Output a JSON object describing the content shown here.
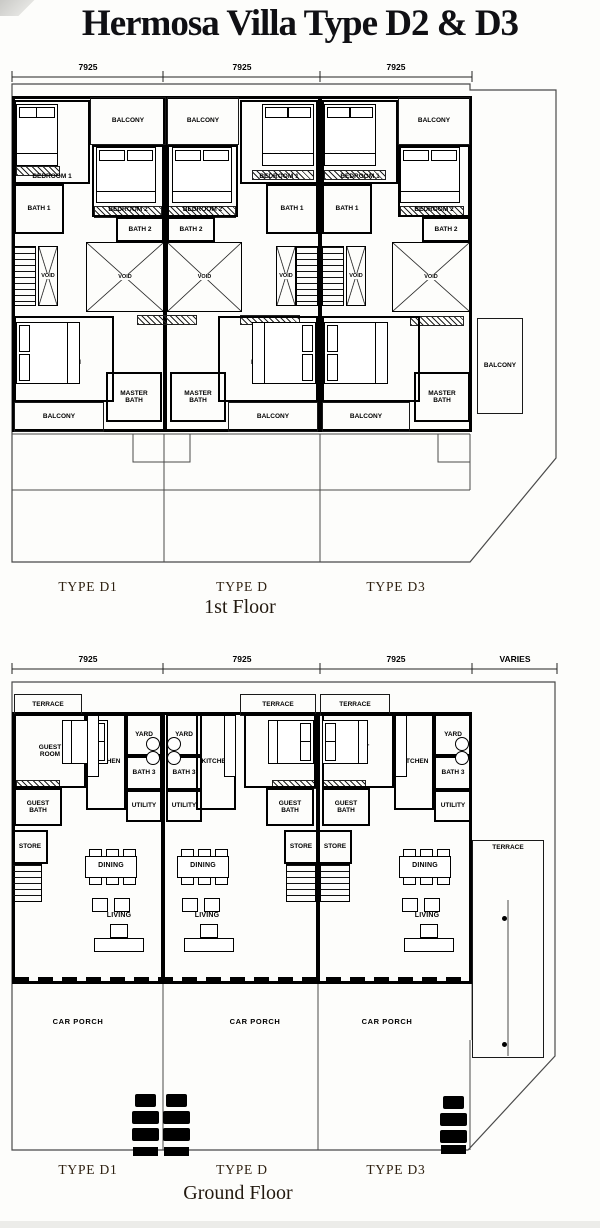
{
  "title": "Hermosa Villa Type D2 & D3",
  "colors": {
    "ink": "#000000",
    "boundary": "#4a4a4a",
    "caption": "#2e2010",
    "title": "#101014",
    "paper": "#fdfdfb"
  },
  "floors": [
    {
      "name": "first-floor",
      "caption": "1st Floor",
      "caption_x": 240,
      "caption_y": 596,
      "type_labels": [
        {
          "text": "TYPE D1",
          "x": 88,
          "y": 579
        },
        {
          "text": "TYPE D",
          "x": 242,
          "y": 579
        },
        {
          "text": "TYPE D3",
          "x": 396,
          "y": 579
        }
      ],
      "dimension": {
        "line_y": 77,
        "label_y": 62,
        "ticks": [
          12,
          163,
          320,
          472
        ],
        "labels": [
          {
            "text": "7925",
            "x": 88
          },
          {
            "text": "7925",
            "x": 242
          },
          {
            "text": "7925",
            "x": 396
          }
        ]
      },
      "boundary": "12,84 470,84 470,90 556,90 556,458 470,562 12,562",
      "lines": [
        "12,434 470,434",
        "133,434 133,462 190,462 190,434",
        "438,434 438,462 470,462",
        "12,490 470,490",
        "164,434 164,562",
        "320,434 320,562",
        "470,434 470,490"
      ],
      "outlines": [
        {
          "x": 12,
          "y": 96,
          "w": 460,
          "h": 336
        }
      ],
      "bars": [
        {
          "x": 163,
          "y": 96,
          "w": 4,
          "h": 336
        },
        {
          "x": 318,
          "y": 96,
          "w": 4,
          "h": 336
        }
      ],
      "rooms": [
        {
          "label": "BEDROOM 1",
          "x": 14,
          "y": 100,
          "w": 76,
          "h": 84,
          "la": "bottom"
        },
        {
          "label": "BALCONY",
          "x": 90,
          "y": 97,
          "w": 76,
          "h": 48,
          "cls": "thin"
        },
        {
          "label": "BATH 1",
          "x": 14,
          "y": 184,
          "w": 50,
          "h": 50
        },
        {
          "label": "BEDROOM 2",
          "x": 92,
          "y": 145,
          "w": 72,
          "h": 72,
          "la": "bottom"
        },
        {
          "label": "BATH 2",
          "x": 116,
          "y": 217,
          "w": 48,
          "h": 25
        },
        {
          "cls": "stairs",
          "x": 14,
          "y": 246,
          "w": 22,
          "h": 60
        },
        {
          "label": "VOID",
          "x": 38,
          "y": 246,
          "w": 20,
          "h": 60,
          "cls": "void"
        },
        {
          "label": "VOID",
          "x": 86,
          "y": 242,
          "w": 78,
          "h": 70,
          "cls": "void"
        },
        {
          "label": "MASTER BEDROOM",
          "x": 14,
          "y": 316,
          "w": 100,
          "h": 86,
          "wrap": 50
        },
        {
          "label": "MASTER BATH",
          "x": 106,
          "y": 372,
          "w": 56,
          "h": 50,
          "wrap": 40
        },
        {
          "label": "BALCONY",
          "x": 14,
          "y": 402,
          "w": 90,
          "h": 30,
          "cls": "thin"
        },
        {
          "label": "BALCONY",
          "x": 167,
          "y": 97,
          "w": 72,
          "h": 48,
          "cls": "thin"
        },
        {
          "label": "BEDROOM 2",
          "x": 167,
          "y": 145,
          "w": 71,
          "h": 72,
          "la": "bottom"
        },
        {
          "label": "BATH 2",
          "x": 167,
          "y": 217,
          "w": 48,
          "h": 25
        },
        {
          "label": "BEDROOM 1",
          "x": 240,
          "y": 100,
          "w": 78,
          "h": 84,
          "la": "bottom"
        },
        {
          "label": "BATH 1",
          "x": 266,
          "y": 184,
          "w": 52,
          "h": 50
        },
        {
          "label": "VOID",
          "x": 167,
          "y": 242,
          "w": 75,
          "h": 70,
          "cls": "void"
        },
        {
          "label": "VOID",
          "x": 276,
          "y": 246,
          "w": 20,
          "h": 60,
          "cls": "void"
        },
        {
          "cls": "stairs",
          "x": 296,
          "y": 246,
          "w": 22,
          "h": 60
        },
        {
          "label": "MASTER BEDROOM",
          "x": 218,
          "y": 316,
          "w": 100,
          "h": 86,
          "wrap": 50
        },
        {
          "label": "MASTER BATH",
          "x": 170,
          "y": 372,
          "w": 56,
          "h": 50,
          "wrap": 40
        },
        {
          "label": "BALCONY",
          "x": 228,
          "y": 402,
          "w": 90,
          "h": 30,
          "cls": "thin"
        },
        {
          "label": "BEDROOM 1",
          "x": 322,
          "y": 100,
          "w": 76,
          "h": 84,
          "la": "bottom"
        },
        {
          "label": "BALCONY",
          "x": 398,
          "y": 97,
          "w": 72,
          "h": 48,
          "cls": "thin"
        },
        {
          "label": "BATH 1",
          "x": 322,
          "y": 184,
          "w": 50,
          "h": 50
        },
        {
          "label": "BEDROOM 2",
          "x": 398,
          "y": 145,
          "w": 72,
          "h": 72,
          "la": "bottom"
        },
        {
          "label": "BATH 2",
          "x": 422,
          "y": 217,
          "w": 48,
          "h": 25
        },
        {
          "cls": "stairs",
          "x": 322,
          "y": 246,
          "w": 22,
          "h": 60
        },
        {
          "label": "VOID",
          "x": 346,
          "y": 246,
          "w": 20,
          "h": 60,
          "cls": "void"
        },
        {
          "label": "VOID",
          "x": 392,
          "y": 242,
          "w": 78,
          "h": 70,
          "cls": "void"
        },
        {
          "label": "MASTER BEDROOM",
          "x": 322,
          "y": 316,
          "w": 98,
          "h": 86,
          "wrap": 50
        },
        {
          "label": "MASTER BATH",
          "x": 414,
          "y": 372,
          "w": 56,
          "h": 50,
          "wrap": 40
        },
        {
          "label": "BALCONY",
          "x": 322,
          "y": 402,
          "w": 88,
          "h": 30,
          "cls": "thin"
        },
        {
          "label": "BALCONY",
          "x": 477,
          "y": 318,
          "w": 46,
          "h": 96,
          "cls": "thin"
        }
      ],
      "hatches": [
        {
          "x": 16,
          "y": 166,
          "w": 44,
          "h": 10
        },
        {
          "x": 252,
          "y": 170,
          "w": 62,
          "h": 10
        },
        {
          "x": 324,
          "y": 170,
          "w": 62,
          "h": 10
        },
        {
          "x": 94,
          "y": 206,
          "w": 68,
          "h": 12
        },
        {
          "x": 168,
          "y": 206,
          "w": 68,
          "h": 12
        },
        {
          "x": 400,
          "y": 206,
          "w": 64,
          "h": 11
        },
        {
          "x": 137,
          "y": 315,
          "w": 60,
          "h": 10
        },
        {
          "x": 240,
          "y": 315,
          "w": 60,
          "h": 10
        },
        {
          "x": 410,
          "y": 316,
          "w": 54,
          "h": 10
        }
      ],
      "furniture": [
        {
          "t": "bed",
          "x": 16,
          "y": 104,
          "w": 42,
          "h": 62,
          "p": "t"
        },
        {
          "t": "bed",
          "x": 96,
          "y": 147,
          "w": 60,
          "h": 56,
          "p": "t"
        },
        {
          "t": "bed",
          "x": 172,
          "y": 147,
          "w": 60,
          "h": 56,
          "p": "t"
        },
        {
          "t": "bed",
          "x": 262,
          "y": 104,
          "w": 52,
          "h": 62,
          "p": "t"
        },
        {
          "t": "bed",
          "x": 324,
          "y": 104,
          "w": 52,
          "h": 62,
          "p": "t"
        },
        {
          "t": "bed",
          "x": 400,
          "y": 147,
          "w": 60,
          "h": 56,
          "p": "t"
        },
        {
          "t": "bed",
          "x": 16,
          "y": 322,
          "w": 64,
          "h": 62,
          "p": "l"
        },
        {
          "t": "bed",
          "x": 252,
          "y": 322,
          "w": 64,
          "h": 62,
          "p": "r"
        },
        {
          "t": "bed",
          "x": 324,
          "y": 322,
          "w": 64,
          "h": 62,
          "p": "l"
        }
      ]
    },
    {
      "name": "ground-floor",
      "caption": "Ground Floor",
      "caption_x": 238,
      "caption_y": 1182,
      "type_labels": [
        {
          "text": "TYPE D1",
          "x": 88,
          "y": 1162
        },
        {
          "text": "TYPE D",
          "x": 242,
          "y": 1162
        },
        {
          "text": "TYPE D3",
          "x": 396,
          "y": 1162
        }
      ],
      "dimension": {
        "line_y": 669,
        "label_y": 654,
        "ticks": [
          12,
          163,
          320,
          472,
          557
        ],
        "labels": [
          {
            "text": "7925",
            "x": 88
          },
          {
            "text": "7925",
            "x": 242
          },
          {
            "text": "7925",
            "x": 396
          },
          {
            "text": "VARIES",
            "x": 515
          }
        ]
      },
      "boundary": "12,682 555,682 555,1056 468,1150 12,1150",
      "lines": [
        "163,984 163,1150",
        "318,984 318,1150",
        "470,1040 470,1150",
        "472,984 472,1040",
        "508,900 508,1056"
      ],
      "outlines": [
        {
          "x": 12,
          "y": 712,
          "w": 460,
          "h": 272
        }
      ],
      "bars": [
        {
          "x": 161,
          "y": 712,
          "w": 4,
          "h": 272
        },
        {
          "x": 316,
          "y": 712,
          "w": 4,
          "h": 272
        }
      ],
      "rooms": [
        {
          "label": "TERRACE",
          "x": 14,
          "y": 694,
          "w": 68,
          "h": 22,
          "cls": "thin"
        },
        {
          "label": "GUEST ROOM",
          "x": 14,
          "y": 714,
          "w": 72,
          "h": 74,
          "wrap": 34
        },
        {
          "label": "KITCHEN",
          "x": 86,
          "y": 714,
          "w": 40,
          "h": 96
        },
        {
          "label": "YARD",
          "x": 126,
          "y": 714,
          "w": 36,
          "h": 42
        },
        {
          "label": "BATH 3",
          "x": 126,
          "y": 756,
          "w": 36,
          "h": 34
        },
        {
          "label": "UTILITY",
          "x": 126,
          "y": 790,
          "w": 36,
          "h": 32
        },
        {
          "label": "GUEST BATH",
          "x": 14,
          "y": 788,
          "w": 48,
          "h": 38,
          "wrap": 30
        },
        {
          "label": "STORE",
          "x": 12,
          "y": 830,
          "w": 36,
          "h": 34
        },
        {
          "cls": "stairs",
          "x": 12,
          "y": 864,
          "w": 30,
          "h": 38
        },
        {
          "label": "DINING",
          "x": 88,
          "y": 860,
          "w": 46,
          "h": 12,
          "cls": "lbl"
        },
        {
          "label": "LIVING",
          "x": 99,
          "y": 911,
          "w": 40,
          "h": 10,
          "cls": "lbl"
        },
        {
          "label": "CAR PORCH",
          "x": 48,
          "y": 1016,
          "w": 60,
          "h": 12,
          "cls": "lbl big"
        },
        {
          "label": "TERRACE",
          "x": 240,
          "y": 694,
          "w": 76,
          "h": 22,
          "cls": "thin"
        },
        {
          "label": "GUEST ROOM",
          "x": 244,
          "y": 714,
          "w": 72,
          "h": 74,
          "wrap": 34
        },
        {
          "label": "KITCHEN",
          "x": 196,
          "y": 714,
          "w": 40,
          "h": 96
        },
        {
          "label": "YARD",
          "x": 166,
          "y": 714,
          "w": 36,
          "h": 42
        },
        {
          "label": "BATH 3",
          "x": 166,
          "y": 756,
          "w": 36,
          "h": 34
        },
        {
          "label": "UTILITY",
          "x": 166,
          "y": 790,
          "w": 36,
          "h": 32
        },
        {
          "label": "GUEST BATH",
          "x": 266,
          "y": 788,
          "w": 48,
          "h": 38,
          "wrap": 30
        },
        {
          "label": "STORE",
          "x": 284,
          "y": 830,
          "w": 34,
          "h": 34
        },
        {
          "cls": "stairs",
          "x": 286,
          "y": 864,
          "w": 30,
          "h": 38
        },
        {
          "label": "DINING",
          "x": 180,
          "y": 860,
          "w": 46,
          "h": 12,
          "cls": "lbl"
        },
        {
          "label": "LIVING",
          "x": 187,
          "y": 911,
          "w": 40,
          "h": 10,
          "cls": "lbl"
        },
        {
          "label": "CAR PORCH",
          "x": 225,
          "y": 1016,
          "w": 60,
          "h": 12,
          "cls": "lbl big"
        },
        {
          "label": "TERRACE",
          "x": 320,
          "y": 694,
          "w": 70,
          "h": 22,
          "cls": "thin"
        },
        {
          "label": "GUEST ROOM",
          "x": 322,
          "y": 714,
          "w": 72,
          "h": 74,
          "wrap": 34
        },
        {
          "label": "KITCHEN",
          "x": 394,
          "y": 714,
          "w": 40,
          "h": 96
        },
        {
          "label": "YARD",
          "x": 434,
          "y": 714,
          "w": 38,
          "h": 42
        },
        {
          "label": "BATH 3",
          "x": 434,
          "y": 756,
          "w": 38,
          "h": 34
        },
        {
          "label": "UTILITY",
          "x": 434,
          "y": 790,
          "w": 38,
          "h": 32
        },
        {
          "label": "GUEST BATH",
          "x": 322,
          "y": 788,
          "w": 48,
          "h": 38,
          "wrap": 30
        },
        {
          "label": "STORE",
          "x": 318,
          "y": 830,
          "w": 34,
          "h": 34
        },
        {
          "cls": "stairs",
          "x": 320,
          "y": 864,
          "w": 30,
          "h": 38
        },
        {
          "label": "DINING",
          "x": 402,
          "y": 860,
          "w": 46,
          "h": 12,
          "cls": "lbl"
        },
        {
          "label": "LIVING",
          "x": 407,
          "y": 911,
          "w": 40,
          "h": 10,
          "cls": "lbl"
        },
        {
          "label": "CAR PORCH",
          "x": 357,
          "y": 1016,
          "w": 60,
          "h": 12,
          "cls": "lbl big"
        },
        {
          "label": "TERRACE",
          "x": 472,
          "y": 840,
          "w": 72,
          "h": 218,
          "cls": "thin",
          "la": "top"
        }
      ],
      "hatches": [
        {
          "x": 16,
          "y": 780,
          "w": 44,
          "h": 9
        },
        {
          "x": 272,
          "y": 780,
          "w": 44,
          "h": 9
        },
        {
          "x": 322,
          "y": 780,
          "w": 44,
          "h": 9
        }
      ],
      "furniture": [
        {
          "t": "bed",
          "x": 62,
          "y": 720,
          "w": 46,
          "h": 44,
          "p": "r"
        },
        {
          "t": "bed",
          "x": 268,
          "y": 720,
          "w": 46,
          "h": 44,
          "p": "r"
        },
        {
          "t": "bed",
          "x": 322,
          "y": 720,
          "w": 46,
          "h": 44,
          "p": "l"
        },
        {
          "t": "counter",
          "x": 87,
          "y": 715,
          "w": 12,
          "h": 62
        },
        {
          "t": "counter",
          "x": 224,
          "y": 715,
          "w": 12,
          "h": 62
        },
        {
          "t": "counter",
          "x": 395,
          "y": 715,
          "w": 12,
          "h": 62
        },
        {
          "t": "circles",
          "x": 146,
          "y": 737,
          "w": 14,
          "h": 28
        },
        {
          "t": "circles",
          "x": 167,
          "y": 737,
          "w": 14,
          "h": 28
        },
        {
          "t": "circles",
          "x": 455,
          "y": 737,
          "w": 14,
          "h": 28
        },
        {
          "t": "dining",
          "x": 84,
          "y": 849,
          "w": 54,
          "h": 36
        },
        {
          "t": "dining",
          "x": 176,
          "y": 849,
          "w": 54,
          "h": 36
        },
        {
          "t": "dining",
          "x": 398,
          "y": 849,
          "w": 54,
          "h": 36
        },
        {
          "t": "sofa",
          "x": 90,
          "y": 898,
          "w": 58,
          "h": 54
        },
        {
          "t": "sofa",
          "x": 180,
          "y": 898,
          "w": 58,
          "h": 54
        },
        {
          "t": "sofa",
          "x": 400,
          "y": 898,
          "w": 58,
          "h": 54
        },
        {
          "t": "dash",
          "x": 14,
          "y": 977,
          "w": 450,
          "h": 5
        },
        {
          "t": "gate",
          "x": 132,
          "y": 1094,
          "w": 27,
          "h": 62
        },
        {
          "t": "gate",
          "x": 163,
          "y": 1094,
          "w": 27,
          "h": 62
        },
        {
          "t": "gate",
          "x": 440,
          "y": 1096,
          "w": 27,
          "h": 58
        },
        {
          "t": "dot",
          "x": 502,
          "y": 916,
          "w": 5,
          "h": 5
        },
        {
          "t": "dot",
          "x": 502,
          "y": 1042,
          "w": 5,
          "h": 5
        }
      ]
    }
  ]
}
